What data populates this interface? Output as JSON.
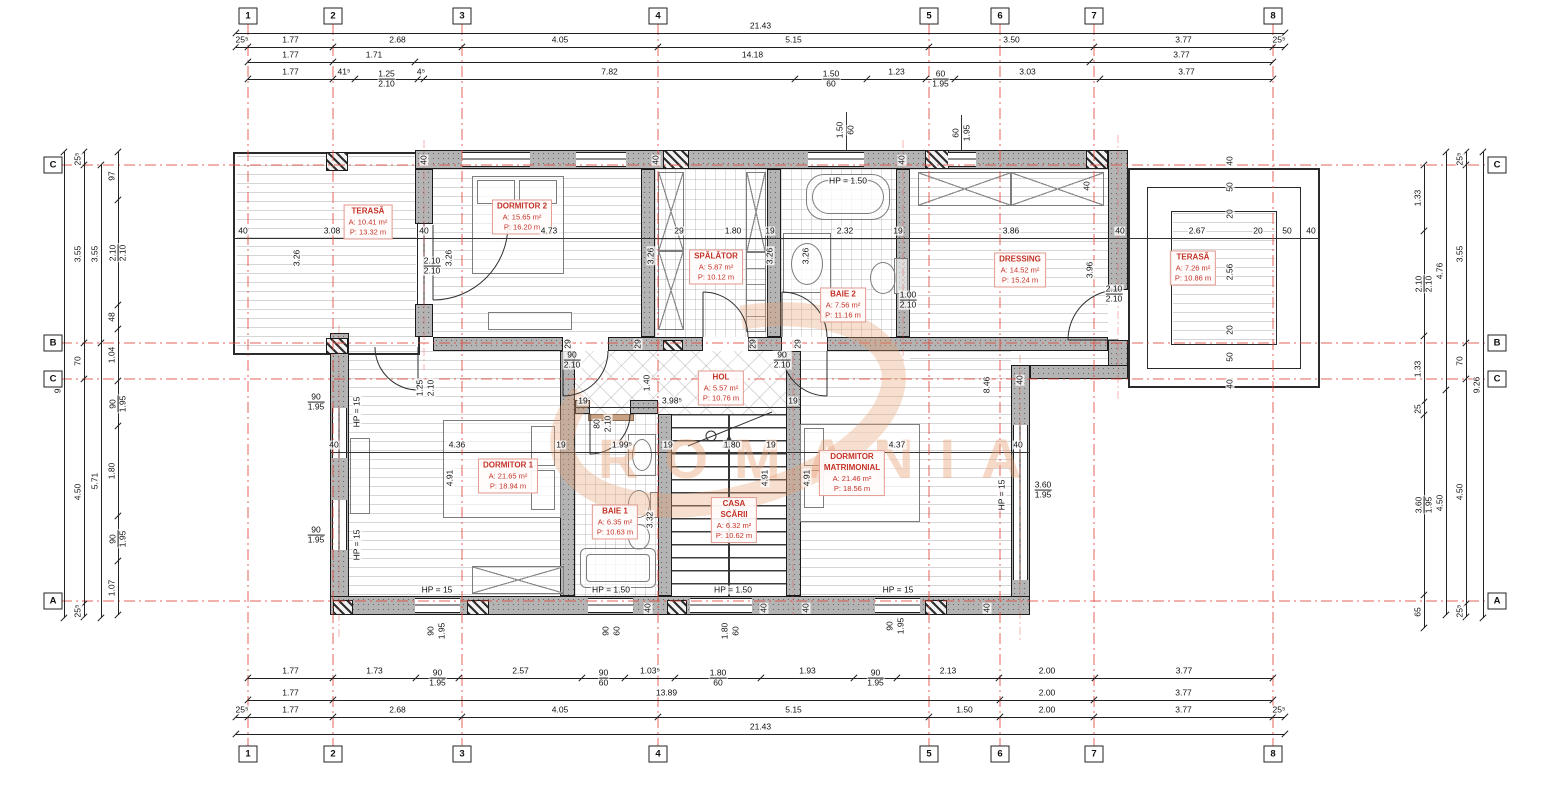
{
  "watermark": {
    "text": "ROMANIA"
  },
  "grid": {
    "col_bubble_y": [
      16,
      754
    ],
    "row_bubble_x": [
      53,
      1497
    ],
    "cols": [
      {
        "n": "1",
        "x": 248
      },
      {
        "n": "2",
        "x": 333
      },
      {
        "n": "3",
        "x": 462
      },
      {
        "n": "4",
        "x": 658
      },
      {
        "n": "5",
        "x": 929
      },
      {
        "n": "6",
        "x": 1000
      },
      {
        "n": "7",
        "x": 1094
      },
      {
        "n": "8",
        "x": 1273
      }
    ],
    "rows": [
      {
        "n": "C",
        "y": 165
      },
      {
        "n": "B",
        "y": 343
      },
      {
        "n": "C",
        "y": 379
      },
      {
        "n": "A",
        "y": 601
      }
    ]
  },
  "dim_rows": [
    {
      "o": "h",
      "y": 33,
      "b": [
        236,
        1285
      ],
      "l": [
        "21.43"
      ]
    },
    {
      "o": "h",
      "y": 47,
      "b": [
        236,
        248,
        333,
        462,
        658,
        929,
        1094,
        1273,
        1285
      ],
      "l": [
        "25⁵",
        "1.77",
        "2.68",
        "4.05",
        "5.15",
        "3.50",
        "3.77",
        "25⁵"
      ]
    },
    {
      "o": "h",
      "y": 62,
      "b": [
        248,
        333,
        415,
        1090,
        1273
      ],
      "l": [
        "1.77",
        "1.71",
        "14.18",
        "3.77"
      ]
    },
    {
      "o": "h",
      "y": 79,
      "b": [
        248,
        333,
        355,
        418,
        424,
        795,
        867,
        926,
        955,
        1100,
        1273
      ],
      "l": [
        "1.77",
        "41⁵",
        {
          "t": "1.25",
          "s": "2.10"
        },
        "4⁵",
        "7.82",
        {
          "t": "1.50",
          "s": "60"
        },
        "1.23",
        {
          "t": "60",
          "s": "1.95"
        },
        "3.03",
        "3.77"
      ]
    },
    {
      "o": "h",
      "y": 678,
      "b": [
        248,
        333,
        416,
        459,
        582,
        625,
        675,
        761,
        854,
        897,
        999,
        1095,
        1273
      ],
      "l": [
        "1.77",
        "1.73",
        {
          "t": "90",
          "s": "1.95"
        },
        "2.57",
        {
          "t": "90",
          "s": "60"
        },
        "1.03⁵",
        {
          "t": "1.80",
          "s": "60"
        },
        "1.93",
        {
          "t": "90",
          "s": "1.95"
        },
        "2.13",
        "2.00",
        "3.77"
      ]
    },
    {
      "o": "h",
      "y": 700,
      "b": [
        248,
        333,
        1000,
        1094,
        1273
      ],
      "l": [
        "1.77",
        "13.89",
        "2.00",
        "3.77"
      ]
    },
    {
      "o": "h",
      "y": 717,
      "b": [
        236,
        248,
        333,
        462,
        658,
        929,
        1000,
        1094,
        1273,
        1285
      ],
      "l": [
        "25⁵",
        "1.77",
        "2.68",
        "4.05",
        "5.15",
        "1.50",
        "2.00",
        "3.77",
        "25⁵"
      ]
    },
    {
      "o": "h",
      "y": 734,
      "b": [
        236,
        1285
      ],
      "l": [
        "21.43"
      ]
    },
    {
      "o": "v",
      "x": 64,
      "b": [
        152,
        618
      ],
      "l": [
        "9.26"
      ]
    },
    {
      "o": "v",
      "x": 84,
      "b": [
        152,
        165,
        343,
        379,
        604,
        617
      ],
      "l": [
        "25⁵",
        "3.55",
        "70",
        "4.50",
        "25⁵"
      ]
    },
    {
      "o": "v",
      "x": 101,
      "b": [
        165,
        343,
        618
      ],
      "l": [
        "3.55",
        "5.71"
      ]
    },
    {
      "o": "v",
      "x": 118,
      "b": [
        152,
        200,
        305,
        329,
        381,
        426,
        516,
        561,
        615
      ],
      "l": [
        "97",
        {
          "t": "2.10",
          "s": "2.10"
        },
        "48",
        "1.04",
        {
          "t": "90",
          "s": "1.95"
        },
        "1.80",
        {
          "t": "90",
          "s": "1.95"
        },
        "1.07"
      ]
    },
    {
      "o": "v",
      "x": 1424,
      "b": [
        165,
        231,
        336,
        402,
        415,
        595,
        628
      ],
      "l": [
        "1.33",
        {
          "t": "2.10",
          "s": "2.10"
        },
        "1.33",
        "25",
        {
          "t": "3.60",
          "s": "1.95"
        },
        "65"
      ]
    },
    {
      "o": "v",
      "x": 1446,
      "b": [
        152,
        390,
        615
      ],
      "l": [
        "4.76",
        "4.50"
      ]
    },
    {
      "o": "v",
      "x": 1466,
      "b": [
        152,
        165,
        343,
        379,
        604,
        617
      ],
      "l": [
        "25⁵",
        "3.55",
        "70",
        "4.50",
        "25⁵"
      ]
    },
    {
      "o": "v",
      "x": 1483,
      "b": [
        152,
        618
      ],
      "l": [
        "9.26"
      ]
    }
  ],
  "inline_dims": [
    {
      "t": "40",
      "x": 243,
      "y": 231
    },
    {
      "t": "3.08",
      "x": 332,
      "y": 231
    },
    {
      "t": "40",
      "x": 424,
      "y": 231
    },
    {
      "t": "4.73",
      "x": 549,
      "y": 231
    },
    {
      "t": "29",
      "x": 679,
      "y": 231
    },
    {
      "t": "1.80",
      "x": 733,
      "y": 231
    },
    {
      "t": "19",
      "x": 770,
      "y": 231
    },
    {
      "t": "2.32",
      "x": 845,
      "y": 231
    },
    {
      "t": "19",
      "x": 898,
      "y": 231
    },
    {
      "t": "3.86",
      "x": 1011,
      "y": 231
    },
    {
      "t": "40",
      "x": 1120,
      "y": 231
    },
    {
      "t": "2.67",
      "x": 1197,
      "y": 231
    },
    {
      "t": "20",
      "x": 1258,
      "y": 231
    },
    {
      "t": "50",
      "x": 1287,
      "y": 231
    },
    {
      "t": "40",
      "x": 1311,
      "y": 231
    },
    {
      "t": "3.26",
      "x": 297,
      "y": 258,
      "r": 1
    },
    {
      "t": "3.26",
      "x": 449,
      "y": 258,
      "r": 1
    },
    {
      "t": "3.26",
      "x": 651,
      "y": 256,
      "r": 1
    },
    {
      "t": "3.26",
      "x": 770,
      "y": 256,
      "r": 1
    },
    {
      "t": "3.26",
      "x": 806,
      "y": 256,
      "r": 1
    },
    {
      "t": "3.96",
      "x": 1090,
      "y": 270,
      "r": 1
    },
    {
      "t": "2.56",
      "x": 1230,
      "y": 272,
      "r": 1
    },
    {
      "t": "40",
      "x": 1230,
      "y": 161,
      "r": 1
    },
    {
      "t": "50",
      "x": 1230,
      "y": 187,
      "r": 1
    },
    {
      "t": "20",
      "x": 1230,
      "y": 214,
      "r": 1
    },
    {
      "t": "20",
      "x": 1230,
      "y": 330,
      "r": 1
    },
    {
      "t": "50",
      "x": 1230,
      "y": 357,
      "r": 1
    },
    {
      "t": "40",
      "x": 1230,
      "y": 384,
      "r": 1
    },
    {
      "t": "40",
      "x": 424,
      "y": 160,
      "r": 1
    },
    {
      "t": "40",
      "x": 656,
      "y": 160,
      "r": 1
    },
    {
      "t": "40",
      "x": 902,
      "y": 160,
      "r": 1
    },
    {
      "t": "40",
      "x": 1087,
      "y": 186,
      "r": 1
    },
    {
      "t": "29",
      "x": 568,
      "y": 344,
      "r": 1
    },
    {
      "t": "29",
      "x": 638,
      "y": 344,
      "r": 1
    },
    {
      "t": "29",
      "x": 753,
      "y": 344,
      "r": 1
    },
    {
      "t": "29",
      "x": 798,
      "y": 344,
      "r": 1
    },
    {
      "t": "1.50",
      "x": 840,
      "y": 130,
      "r": 1
    },
    {
      "t": "60",
      "x": 851,
      "y": 130,
      "r": 1
    },
    {
      "t": "60",
      "x": 956,
      "y": 133,
      "r": 1
    },
    {
      "t": "1.95",
      "x": 967,
      "y": 133,
      "r": 1
    },
    {
      "t": "HP = 1.50",
      "x": 848,
      "y": 181
    },
    {
      "t": "90",
      "x": 572,
      "y": 360,
      "s": "2.10"
    },
    {
      "t": "90",
      "x": 782,
      "y": 360,
      "s": "2.10"
    },
    {
      "t": "2.10",
      "x": 432,
      "y": 266,
      "s": "2.10"
    },
    {
      "t": "1.00",
      "x": 908,
      "y": 300,
      "s": "2.10"
    },
    {
      "t": "2.10",
      "x": 1114,
      "y": 294,
      "s": "2.10"
    },
    {
      "t": "1.40",
      "x": 647,
      "y": 383,
      "r": 1
    },
    {
      "t": "19",
      "x": 583,
      "y": 401
    },
    {
      "t": "3.98⁵",
      "x": 672,
      "y": 401
    },
    {
      "t": "19",
      "x": 793,
      "y": 401
    },
    {
      "t": "80",
      "x": 597,
      "y": 424,
      "r": 1
    },
    {
      "t": "2.10",
      "x": 608,
      "y": 424,
      "r": 1
    },
    {
      "t": "1.25",
      "x": 420,
      "y": 388,
      "r": 1
    },
    {
      "t": "2.10",
      "x": 431,
      "y": 388,
      "r": 1
    },
    {
      "t": "40",
      "x": 334,
      "y": 445
    },
    {
      "t": "4.36",
      "x": 457,
      "y": 445
    },
    {
      "t": "19",
      "x": 561,
      "y": 445
    },
    {
      "t": "1.99⁵",
      "x": 622,
      "y": 445
    },
    {
      "t": "19",
      "x": 668,
      "y": 445
    },
    {
      "t": "1.80",
      "x": 732,
      "y": 445
    },
    {
      "t": "19",
      "x": 771,
      "y": 445
    },
    {
      "t": "4.37",
      "x": 897,
      "y": 445
    },
    {
      "t": "40",
      "x": 1018,
      "y": 445
    },
    {
      "t": "4.91",
      "x": 450,
      "y": 478,
      "r": 1
    },
    {
      "t": "4.91",
      "x": 765,
      "y": 478,
      "r": 1
    },
    {
      "t": "4.91",
      "x": 807,
      "y": 478,
      "r": 1
    },
    {
      "t": "3.32",
      "x": 650,
      "y": 520,
      "r": 1
    },
    {
      "t": "8.46",
      "x": 987,
      "y": 385,
      "r": 1
    },
    {
      "t": "HP = 15",
      "x": 357,
      "y": 412,
      "r": 1
    },
    {
      "t": "HP = 15",
      "x": 357,
      "y": 545,
      "r": 1
    },
    {
      "t": "90",
      "x": 316,
      "y": 402,
      "s": "1.95"
    },
    {
      "t": "90",
      "x": 316,
      "y": 535,
      "s": "1.95"
    },
    {
      "t": "HP = 15",
      "x": 437,
      "y": 590
    },
    {
      "t": "HP = 1.50",
      "x": 611,
      "y": 590
    },
    {
      "t": "HP = 1.50",
      "x": 733,
      "y": 590
    },
    {
      "t": "HP = 15",
      "x": 898,
      "y": 590
    },
    {
      "t": "90",
      "x": 431,
      "y": 631,
      "r": 1
    },
    {
      "t": "1.95",
      "x": 442,
      "y": 631,
      "r": 1
    },
    {
      "t": "90",
      "x": 606,
      "y": 631,
      "r": 1
    },
    {
      "t": "60",
      "x": 617,
      "y": 631,
      "r": 1
    },
    {
      "t": "1.80",
      "x": 725,
      "y": 631,
      "r": 1
    },
    {
      "t": "60",
      "x": 736,
      "y": 631,
      "r": 1
    },
    {
      "t": "90",
      "x": 890,
      "y": 626,
      "r": 1
    },
    {
      "t": "1.95",
      "x": 901,
      "y": 626,
      "r": 1
    },
    {
      "t": "40",
      "x": 648,
      "y": 608,
      "r": 1
    },
    {
      "t": "40",
      "x": 764,
      "y": 608,
      "r": 1
    },
    {
      "t": "40",
      "x": 806,
      "y": 608,
      "r": 1
    },
    {
      "t": "40",
      "x": 987,
      "y": 608,
      "r": 1
    },
    {
      "t": "HP = 15",
      "x": 1002,
      "y": 495,
      "r": 1
    },
    {
      "t": "3.60",
      "x": 1043,
      "y": 490,
      "s": "1.95"
    },
    {
      "t": "40",
      "x": 1020,
      "y": 380,
      "r": 1
    }
  ],
  "rooms": [
    {
      "name": "TERASĂ",
      "a": "A: 10.41 m²",
      "p": "P: 13.32 m",
      "x": 368,
      "y": 222
    },
    {
      "name": "DORMITOR 2",
      "a": "A: 15.65 m²",
      "p": "P: 16.20 m",
      "x": 522,
      "y": 217
    },
    {
      "name": "SPĂLĂTOR",
      "a": "A: 5.87 m²",
      "p": "P: 10.12 m",
      "x": 716,
      "y": 267
    },
    {
      "name": "BAIE 2",
      "a": "A: 7.56 m²",
      "p": "P: 11.16 m",
      "x": 843,
      "y": 305
    },
    {
      "name": "DRESSING",
      "a": "A: 14.52 m²",
      "p": "P: 15.24 m",
      "x": 1020,
      "y": 270
    },
    {
      "name": "TERASĂ",
      "a": "A: 7.26 m²",
      "p": "P: 10.86 m",
      "x": 1193,
      "y": 268
    },
    {
      "name": "HOL",
      "a": "A: 5.57 m²",
      "p": "P: 10.76 m",
      "x": 721,
      "y": 388
    },
    {
      "name": "DORMITOR 1",
      "a": "A: 21.65 m²",
      "p": "P: 18.94 m",
      "x": 508,
      "y": 476
    },
    {
      "name": "BAIE 1",
      "a": "A: 6.35 m²",
      "p": "P: 10.63 m",
      "x": 615,
      "y": 522
    },
    {
      "name": "CASA\nSCĂRII",
      "a": "A: 6.32 m²",
      "p": "P: 10.62 m",
      "x": 734,
      "y": 520
    },
    {
      "name": "DORMITOR\nMATRIMONIAL",
      "a": "A: 21.46 m²",
      "p": "P: 18.56 m",
      "x": 852,
      "y": 473
    }
  ]
}
